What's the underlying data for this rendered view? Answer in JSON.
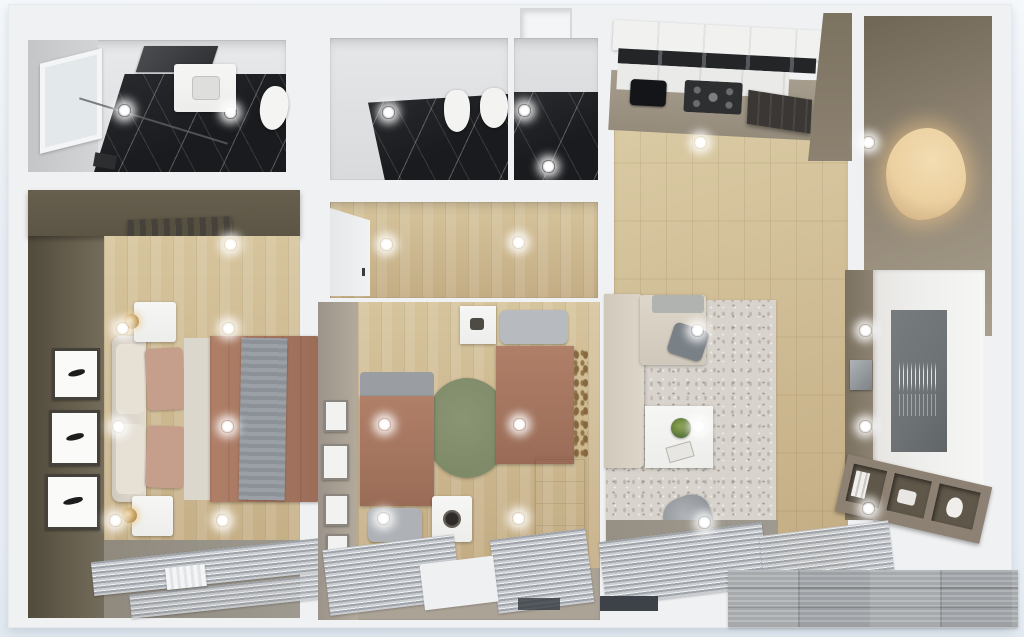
{
  "scene": {
    "type": "3d-floor-plan-render",
    "view": "top-down",
    "visible_text": "none",
    "overlay": {
      "id": "striped-grey-block",
      "description": "grey striped rectangular block overlapping the bottom-right corner of the render"
    }
  },
  "rooms": [
    {
      "id": "bathroom-1",
      "position": "top-left",
      "ceiling_lights": 2,
      "features": [
        "window",
        "vanity-sink",
        "dark-mirror",
        "toilet",
        "dark-marble-floor",
        "glass-partition"
      ]
    },
    {
      "id": "bathroom-2",
      "position": "top-middle",
      "ceiling_lights": 3,
      "features": [
        "bidet",
        "toilet",
        "dark-marble-floor",
        "shower-stall",
        "wall-niche"
      ]
    },
    {
      "id": "hallway",
      "position": "middle-center",
      "ceiling_lights": 2,
      "features": [
        "built-in-wardrobe",
        "wood-floor"
      ]
    },
    {
      "id": "master-bedroom",
      "position": "left",
      "ceiling_lights": 7,
      "features": [
        "double-bed",
        "terracotta-duvet",
        "grey-throw",
        "upholstered-headboard",
        "two-nightstands",
        "two-gold-lamps",
        "three-wall-artworks",
        "dark-olive-accent-wall",
        "dark-wardrobe",
        "striped-window-curtains",
        "white-radiator"
      ]
    },
    {
      "id": "kids-bedroom",
      "position": "bottom-middle",
      "ceiling_lights": 4,
      "features": [
        "two-single-beds",
        "terracotta-duvets",
        "round-green-rug",
        "play-cube-with-round-door",
        "white-wardrobe",
        "small-wall-frames",
        "wall-vine-decor",
        "striped-window-curtains"
      ]
    },
    {
      "id": "living-room-kitchen",
      "position": "right",
      "ceiling_lights": 8,
      "features": [
        "white-kitchen-cabinets",
        "dark-glass-upper-cabinets",
        "black-sink",
        "gas-hob",
        "extractor-hood",
        "taupe-walls",
        "backlit-organic-mirror",
        "corner-sofa",
        "grey-throw-pillow",
        "white-coffee-table",
        "potted-plant",
        "grey-armchair",
        "patterned-rug",
        "tv-panel-wall",
        "tv-with-skyline-art",
        "wall-speaker",
        "media-shelf-unit",
        "striped-window-curtains"
      ]
    }
  ],
  "palette": {
    "bg": "#e9eff5",
    "bg-edge": "#f6f9fc",
    "wall": "#f0f1f3",
    "wall-shade": "#d9dbde",
    "grey-wall": "#c9cbcd",
    "marble-dark": "#1a1b1e",
    "wood-warm": "#c3ac83",
    "wood-light": "#d6c49c",
    "wood-pale": "#dcCDa6",
    "olive-wall": "#675f4e",
    "olive-dark": "#514b3c",
    "greige-wall": "#a89f92",
    "taupe-wall": "#8d8271",
    "taupe-light": "#a99f8d",
    "terracotta": "#b07f68",
    "terracotta-dark": "#9a6c57",
    "bedding-grey": "#9aa0a6",
    "pillow-pink": "#c69e8c",
    "rug-living": "#d8d3cc",
    "rug-green": "#7e8a68",
    "curtain-a": "#c9ccd0",
    "curtain-b": "#9fa4aa",
    "floor-grey": "#9f9a90",
    "white-furn": "#ededeb",
    "black-appliance": "#141518",
    "hood-dark": "#3a3734",
    "tv-grey": "#6d7275",
    "tv-panel": "#eeeeec",
    "lamp-gold": "#bb9150",
    "mirror-glow": "#ecd0a0",
    "artifact-grey": "#9da0a4",
    "window-dark": "#3c4248"
  }
}
